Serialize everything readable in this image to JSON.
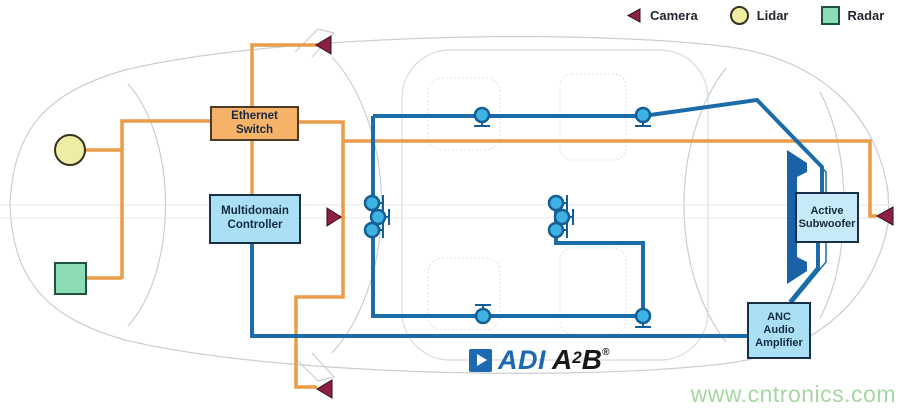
{
  "legend": {
    "items": [
      {
        "id": "camera",
        "label": "Camera"
      },
      {
        "id": "lidar",
        "label": "Lidar"
      },
      {
        "id": "radar",
        "label": "Radar"
      }
    ]
  },
  "components": {
    "ethernet_switch": {
      "label": "Ethernet Switch"
    },
    "multidomain_controller": {
      "label": "Multidomain Controller"
    },
    "active_subwoofer": {
      "label": "Active Subwoofer"
    },
    "anc_amplifier": {
      "label": "ANC Audio Amplifier"
    }
  },
  "logo": {
    "adi": "ADI",
    "a2b_base": "A",
    "a2b_sup": "2",
    "a2b_tail": "B",
    "registered": "®"
  },
  "watermark": "www.cntronics.com",
  "colors": {
    "ethernet_wire": "#E99C49",
    "audio_wire": "#1B6CA8",
    "box_orange_fill": "#F7B269",
    "box_orange_border": "#4A3A26",
    "box_blue_fill": "#ABE0F4",
    "box_blue_border": "#16304A",
    "subwoofer_fill": "#C7EAF8",
    "subwoofer_icon": "#1A62A6",
    "speaker_fill": "#3FB2E4",
    "speaker_border": "#135E94",
    "camera": "#8E2141",
    "lidar_fill": "#EFECA4",
    "radar_fill": "#8BDCB4",
    "logo_blue": "#1E68B2",
    "watermark": "#A6D7A2",
    "car_outline": "#C9CED3"
  },
  "speaker_nodes": [
    {
      "x": 482,
      "y": 115,
      "dir": "down"
    },
    {
      "x": 643,
      "y": 115,
      "dir": "down"
    },
    {
      "x": 372,
      "y": 203,
      "dir": "right"
    },
    {
      "x": 378,
      "y": 217,
      "dir": "right"
    },
    {
      "x": 372,
      "y": 230,
      "dir": "right"
    },
    {
      "x": 556,
      "y": 203,
      "dir": "right"
    },
    {
      "x": 562,
      "y": 217,
      "dir": "right"
    },
    {
      "x": 556,
      "y": 230,
      "dir": "right"
    },
    {
      "x": 483,
      "y": 316,
      "dir": "up"
    },
    {
      "x": 643,
      "y": 316,
      "dir": "down"
    }
  ]
}
